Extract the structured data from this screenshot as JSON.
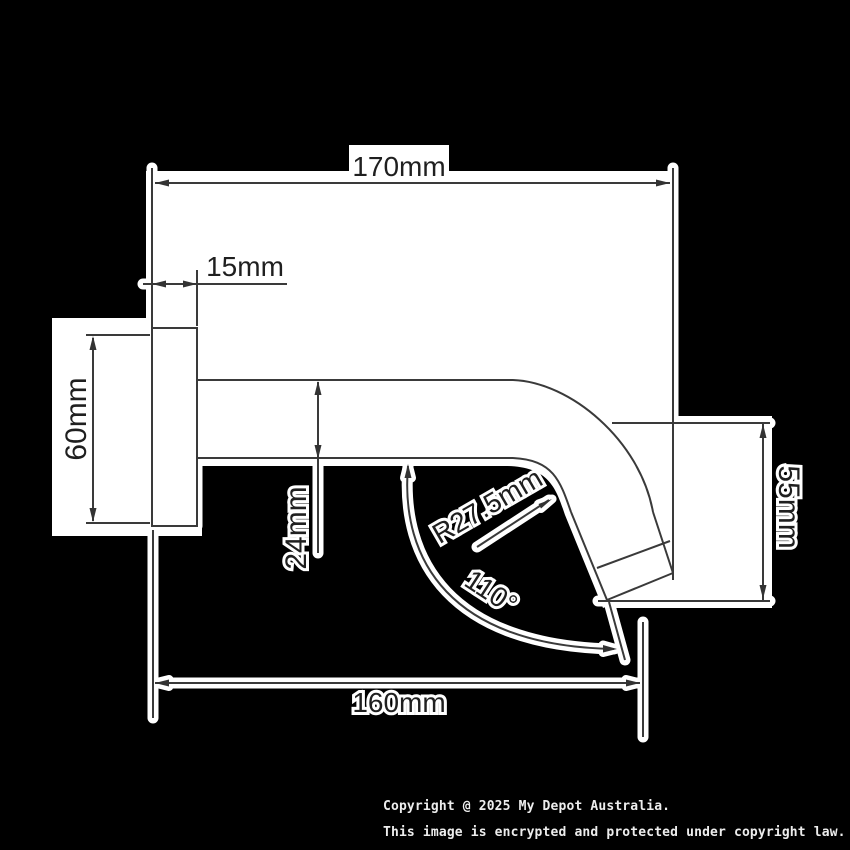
{
  "title": "Wall mounted spout dimension diagram",
  "colors": {
    "background": "#000000",
    "drawing_background": "#ffffff",
    "line": "#3a3a3a",
    "dimension_text": "#1f1f1f",
    "footer_text": "#ededed"
  },
  "dimensions": {
    "total_length": "170mm",
    "wall_plate_depth": "15mm",
    "wall_plate_height": "60mm",
    "spout_diameter": "24mm",
    "bend_radius": "R27.5mm",
    "bend_angle": "110°",
    "outlet_height": "55mm",
    "reach": "160mm"
  },
  "footer": {
    "line1": "Copyright @ 2025 My Depot Australia.",
    "line2": "This image is encrypted and protected under copyright law."
  }
}
